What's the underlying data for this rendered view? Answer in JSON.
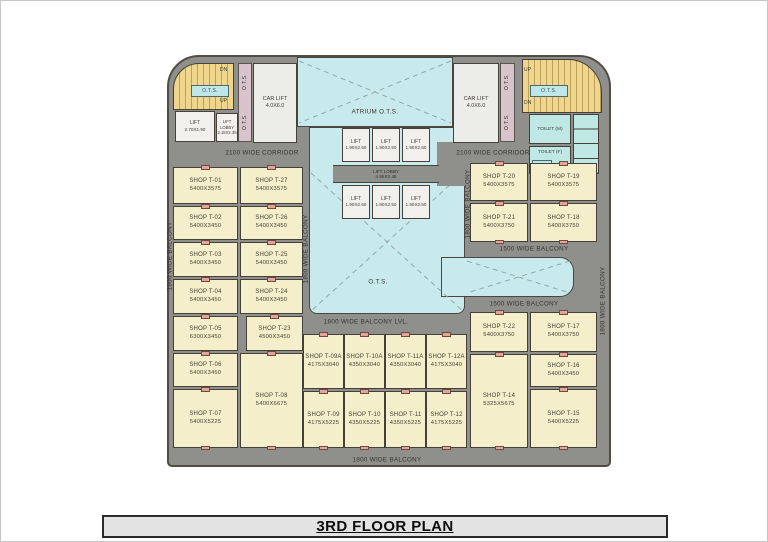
{
  "title": "3RD FLOOR PLAN",
  "labels": {
    "corridor_2100": "2100 WIDE CORRIDOR",
    "balcony_1800": "1800 WIDE BALCONY",
    "balcony_1800_lvl": "1800 WIDE BALCONY LVL.",
    "balcony_1500": "1500 WIDE BALCONY"
  },
  "core": {
    "atrium": "ATRIUM O.T.S.",
    "ots": "O.T.S.",
    "up": "UP",
    "dn": "DN",
    "car_lift": {
      "name": "CAR LIFT",
      "size": "4.0X6.0"
    },
    "lift_left": {
      "name": "LIFT",
      "size": "2.70X1.90"
    },
    "lift_lobby_left": {
      "name": "LIFT LOBBY",
      "size": "2.15X2.35"
    },
    "lift": {
      "name": "LIFT",
      "size": "1.90X2.50"
    },
    "lift_lobby": {
      "name": "LIFT LOBBY",
      "size": "4.65X2.45"
    },
    "toilet_m": "TOILET (M)",
    "toilet_f": "TOILET (F)"
  },
  "shops": {
    "t01": {
      "name": "SHOP T-01",
      "size": "5400X3575"
    },
    "t02": {
      "name": "SHOP T-02",
      "size": "5400X3450"
    },
    "t03": {
      "name": "SHOP T-03",
      "size": "5400X3450"
    },
    "t04": {
      "name": "SHOP T-04",
      "size": "5400X3450"
    },
    "t05": {
      "name": "SHOP T-05",
      "size": "6300X3450"
    },
    "t06": {
      "name": "SHOP T-06",
      "size": "5400X3450"
    },
    "t07": {
      "name": "SHOP T-07",
      "size": "5400X5225"
    },
    "t08": {
      "name": "SHOP T-08",
      "size": "5400X6675"
    },
    "t09a": {
      "name": "SHOP T-09A",
      "size": "4175X3040"
    },
    "t10a": {
      "name": "SHOP T-10A",
      "size": "4350X3040"
    },
    "t11a": {
      "name": "SHOP T-11A",
      "size": "4350X3040"
    },
    "t12a": {
      "name": "SHOP T-12A",
      "size": "4175X3040"
    },
    "t09": {
      "name": "SHOP T-09",
      "size": "4175X5225"
    },
    "t10": {
      "name": "SHOP T-10",
      "size": "4350X5225"
    },
    "t11": {
      "name": "SHOP T-11",
      "size": "4350X5225"
    },
    "t12": {
      "name": "SHOP T-12",
      "size": "4175X5225"
    },
    "t14": {
      "name": "SHOP T-14",
      "size": "5325X5675"
    },
    "t15": {
      "name": "SHOP T-15",
      "size": "5400X5225"
    },
    "t16": {
      "name": "SHOP T-16",
      "size": "5400X3450"
    },
    "t17": {
      "name": "SHOP T-17",
      "size": "5400X3750"
    },
    "t18": {
      "name": "SHOP T-18",
      "size": "5400X3750"
    },
    "t19": {
      "name": "SHOP T-19",
      "size": "5400X3575"
    },
    "t20": {
      "name": "SHOP T-20",
      "size": "5400X3575"
    },
    "t21": {
      "name": "SHOP T-21",
      "size": "5400X3750"
    },
    "t22": {
      "name": "SHOP T-22",
      "size": "5400X3750"
    },
    "t23": {
      "name": "SHOP T-23",
      "size": "4500X3450"
    },
    "t24": {
      "name": "SHOP T-24",
      "size": "5400X3450"
    },
    "t25": {
      "name": "SHOP T-25",
      "size": "5400X3450"
    },
    "t26": {
      "name": "SHOP T-26",
      "size": "5400X3450"
    },
    "t27": {
      "name": "SHOP T-27",
      "size": "5400X3575"
    }
  },
  "colors": {
    "slab": "#8f8f8b",
    "shop": "#f4eecb",
    "court": "#c9eaec",
    "stair": "#f0d68c",
    "strip": "#d8c2cb",
    "marker": "#e2a49b",
    "liftroom": "#f1f0ec",
    "toilet": "#bfe7e3",
    "titlebar": "#e3e3e3"
  }
}
